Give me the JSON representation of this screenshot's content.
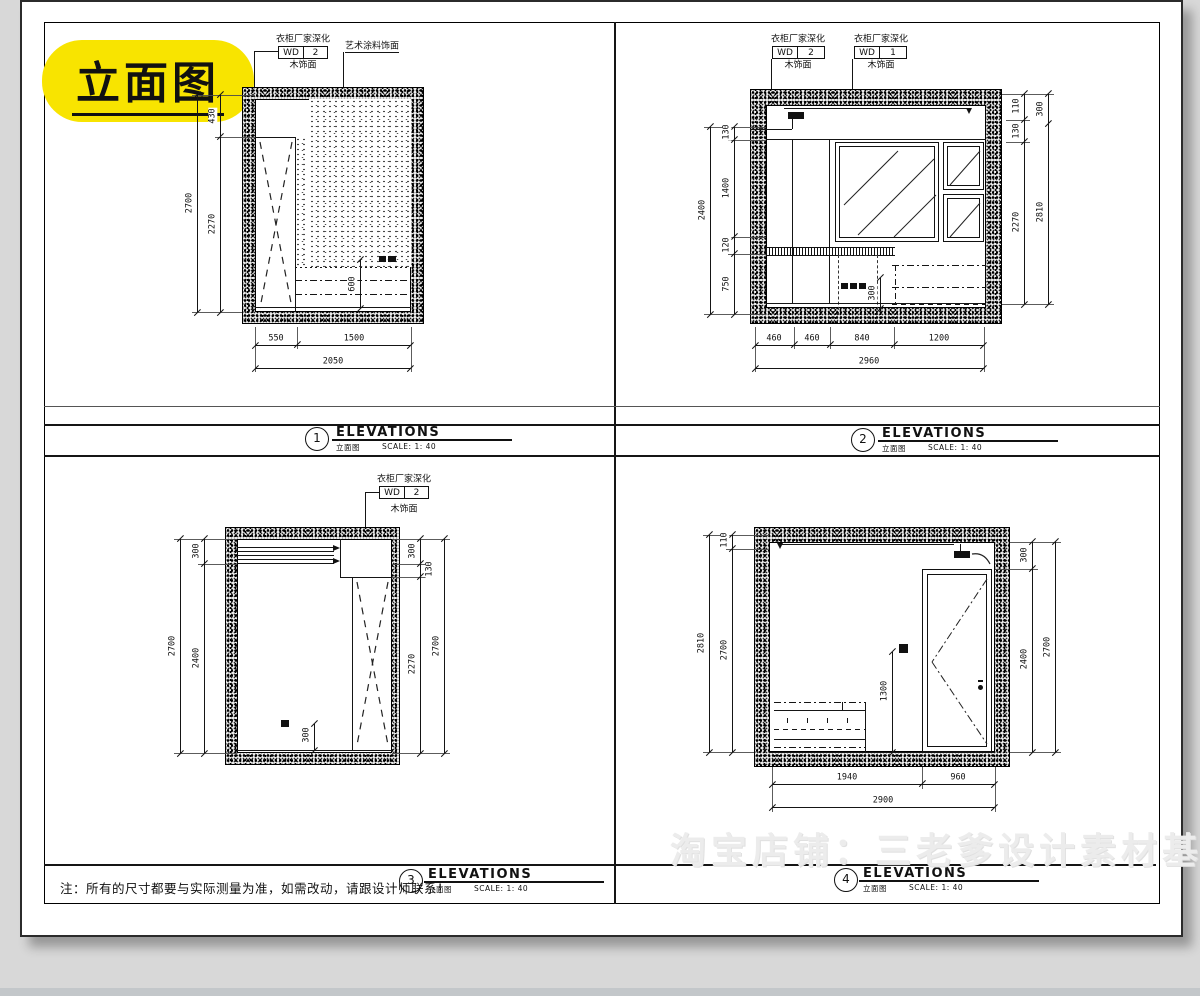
{
  "badge": {
    "text": "立面图"
  },
  "note": {
    "text": "注：所有的尺寸都要与实际测量为准，如需改动，请跟设计师联系！"
  },
  "watermark": {
    "text": "淘宝店铺：三老爹设计素材基地"
  },
  "callouts": {
    "wardrobe_title": "衣柜厂家深化",
    "code": "WD",
    "num1": "1",
    "num2": "2",
    "wood": "木饰面",
    "art_paint": "艺术涂料饰面"
  },
  "titleblocks": {
    "t1": {
      "num": "1",
      "title": "ELEVATIONS",
      "sub": "立面图",
      "scale": "SCALE: 1: 40"
    },
    "t2": {
      "num": "2",
      "title": "ELEVATIONS",
      "sub": "立面图",
      "scale": "SCALE: 1: 40"
    },
    "t3": {
      "num": "3",
      "title": "ELEVATIONS",
      "sub": "立面图",
      "scale": "SCALE: 1: 40"
    },
    "t4": {
      "num": "4",
      "title": "ELEVATIONS",
      "sub": "立面图",
      "scale": "SCALE: 1: 40"
    }
  },
  "dims": {
    "d1": {
      "oh": "2700",
      "t": "430",
      "ih": "2270",
      "cab": "600",
      "b1": "550",
      "b2": "1500",
      "bt": "2050"
    },
    "d2": {
      "lo": "2400",
      "l1": "130",
      "l2": "1400",
      "l3": "120",
      "l4": "750",
      "r1": "110",
      "r2": "130",
      "r3": "2270",
      "ro1": "300",
      "ro2": "2810",
      "b1": "460",
      "b2": "460",
      "b3": "840",
      "b4": "1200",
      "bt": "2960",
      "chair": "300"
    },
    "d3": {
      "lo": "2700",
      "l1": "300",
      "l2": "2400",
      "r1": "300",
      "r2": "130",
      "r3": "2270",
      "ro": "2700",
      "sock": "300"
    },
    "d4": {
      "lo": "2810",
      "l1": "110",
      "l2": "2700",
      "r1": "300",
      "r2": "2400",
      "ro": "2700",
      "b1": "1940",
      "b2": "960",
      "bt": "2900",
      "sw": "1300"
    }
  }
}
